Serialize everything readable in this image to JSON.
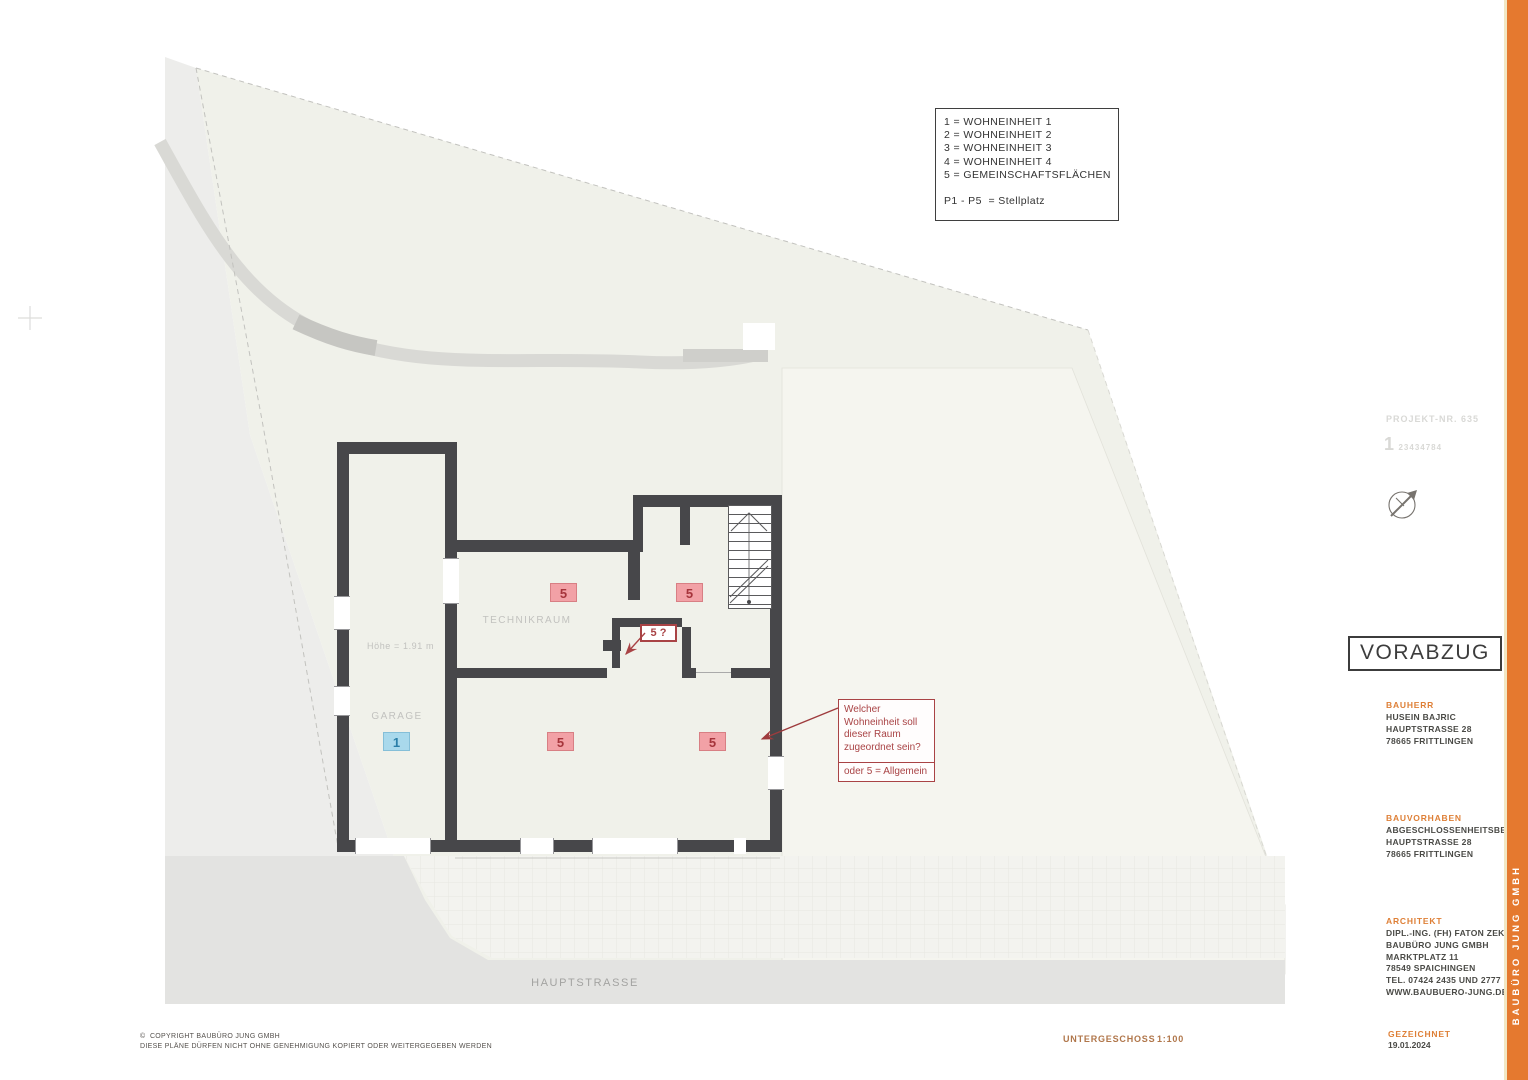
{
  "legend": {
    "lines": [
      "1 = WOHNEINHEIT 1",
      "2 = WOHNEINHEIT 2",
      "3 = WOHNEINHEIT 3",
      "4 = WOHNEINHEIT 4",
      "5 = GEMEINSCHAFTSFLÄCHEN"
    ],
    "stellplatz": "P1 - P5  = Stellplatz"
  },
  "plan": {
    "rooms": {
      "technikraum": "TECHNIKRAUM",
      "garage": "GARAGE",
      "hoehe": "Höhe = 1.91 m"
    },
    "unit_labels": [
      "5",
      "5",
      "5",
      "5",
      "1"
    ],
    "question_tag": "5 ?",
    "street": "HAUPTSTRASSE"
  },
  "annotation": {
    "question": "Welcher\nWohneinheit soll\ndieser Raum\nzugeordnet sein?",
    "alternative": "oder 5 = Allgemein"
  },
  "titleblock": {
    "projekt_nr": "PROJEKT-NR. 635",
    "code_prefix": "1",
    "code_digits": "23434784",
    "stamp": "VORABZUG",
    "bauherr": {
      "label": "BAUHERR",
      "lines": [
        "HUSEIN BAJRIC",
        "HAUPTSTRASSE 28",
        "78665 FRITTLINGEN"
      ]
    },
    "bauvorhaben": {
      "label": "BAUVORHABEN",
      "lines": [
        "ABGESCHLOSSENHEITSBESCHEINIGUNG",
        "HAUPTSTRASSE 28",
        "78665 FRITTLINGEN"
      ]
    },
    "architekt": {
      "label": "ARCHITEKT",
      "lines": [
        "DIPL.-ING. (FH) FATON ZEKA",
        "BAUBÜRO JUNG GMBH",
        "MARKTPLATZ 11",
        "78549 SPAICHINGEN",
        "TEL. 07424 2435 UND 2777",
        "WWW.BAUBUERO-JUNG.DE"
      ]
    },
    "gezeichnet_label": "GEZEICHNET",
    "gezeichnet_date": "19.01.2024",
    "brand": "BAUBÜRO JUNG GMBH"
  },
  "footer": {
    "copyright": "©  COPYRIGHT BAUBÜRO JUNG GMBH\nDIESE PLÄNE DÜRFEN NICHT OHNE GENEHMIGUNG KOPIERT ODER WEITERGEGEBEN WERDEN",
    "sheet_name": "UNTERGESCHOSS",
    "scale": "1:100"
  },
  "colors": {
    "wall": "#47474A",
    "accent_orange": "#E5792F",
    "annotation_red": "#A94345",
    "unit_pink": "#F2A1A6",
    "unit_blue": "#A9D9EC"
  }
}
